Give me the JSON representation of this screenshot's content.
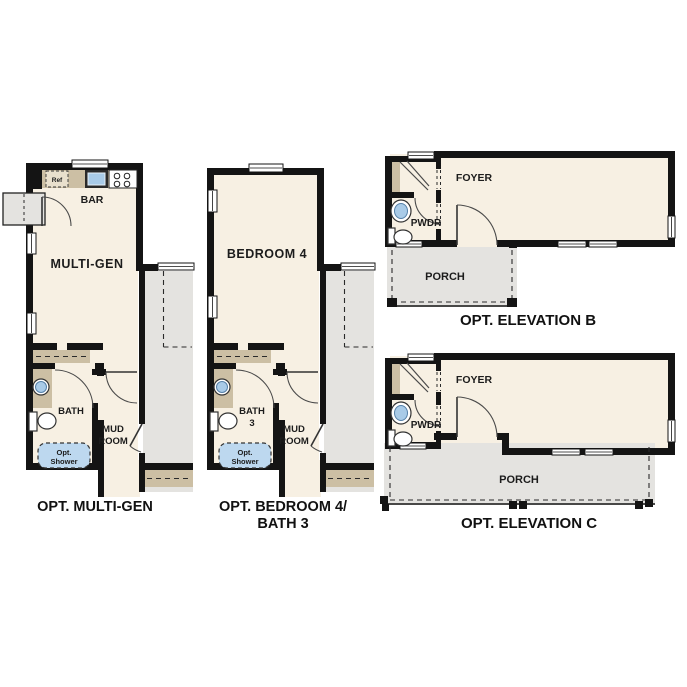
{
  "document_type": "floor-plan-options-sheet",
  "colors": {
    "background": "#ffffff",
    "room_fill": "#f7f0e3",
    "adjacent_area_fill": "#e4e3e0",
    "counter_fill": "#ccbfa4",
    "fixture_blue": "#a9cbe8",
    "shower_blue": "#bdd8ef",
    "wall": "#141414",
    "text": "#1c1c1c"
  },
  "plans": {
    "opt_multi_gen": {
      "caption": "OPT. MULTI-GEN",
      "labels": {
        "ref": "Ref",
        "bar": "BAR",
        "main": "MULTI-GEN",
        "bath": "BATH",
        "mud1": "MUD",
        "mud2": "ROOM",
        "shower1": "Opt.",
        "shower2": "Shower"
      }
    },
    "opt_bedroom4": {
      "caption1": "OPT. BEDROOM 4/",
      "caption2": "BATH 3",
      "labels": {
        "main": "BEDROOM 4",
        "bath1": "BATH",
        "bath2": "3",
        "mud1": "MUD",
        "mud2": "ROOM",
        "shower1": "Opt.",
        "shower2": "Shower"
      }
    },
    "opt_elevation_b": {
      "caption": "OPT. ELEVATION B",
      "labels": {
        "foyer": "FOYER",
        "pwdr": "PWDR",
        "porch": "PORCH"
      }
    },
    "opt_elevation_c": {
      "caption": "OPT. ELEVATION C",
      "labels": {
        "foyer": "FOYER",
        "pwdr": "PWDR",
        "porch": "PORCH"
      }
    }
  }
}
